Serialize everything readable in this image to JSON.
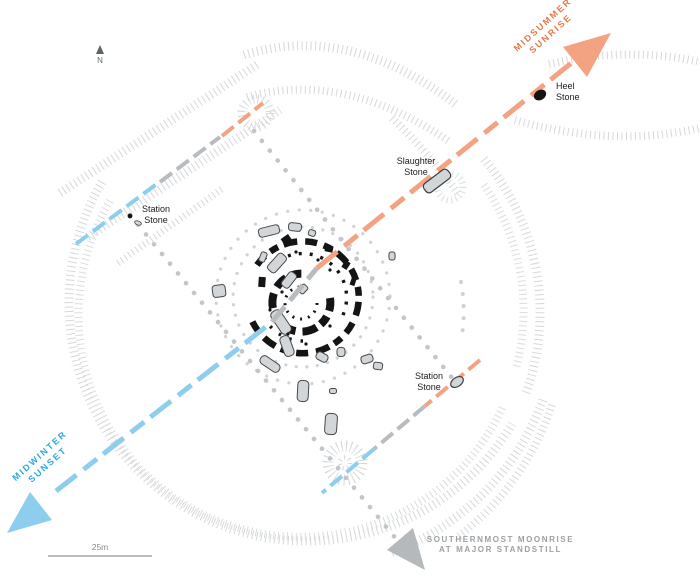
{
  "map": {
    "title": "Stonehenge alignment plan",
    "north_indicator": "N",
    "scale_bar": "25m",
    "alignments": {
      "midsummer_sunrise": {
        "line1": "MIDSUMMER",
        "line2": "SUNRISE",
        "color": "#e4794b"
      },
      "midwinter_sunset": {
        "line1": "MIDWINTER",
        "line2": "SUNSET",
        "color": "#2fa8e1"
      },
      "southernmost_moonrise": {
        "line1": "SOUTHERNMOST MOONRISE",
        "line2": "AT MAJOR STANDSTILL",
        "color": "#9ba0a3"
      }
    },
    "stones": {
      "heel": {
        "line1": "Heel",
        "line2": "Stone"
      },
      "slaughter": {
        "line1": "Slaughter",
        "line2": "Stone"
      },
      "station_nw": {
        "line1": "Station",
        "line2": "Stone"
      },
      "station_se": {
        "line1": "Station",
        "line2": "Stone"
      }
    },
    "colors": {
      "sunrise_dash": "#f3a282",
      "sunset_dash": "#8dcdee",
      "neutral_dash": "#b8bcbf",
      "moon_arrow": "#b5b9bc",
      "hatch": "#d5d8da",
      "hole_dots": "#cfd3d6",
      "rectangle_dots": "#c2c6c9",
      "stone_fill": "#d3d6d8",
      "stone_outline": "#3a3f42",
      "black_stone": "#141414"
    }
  }
}
